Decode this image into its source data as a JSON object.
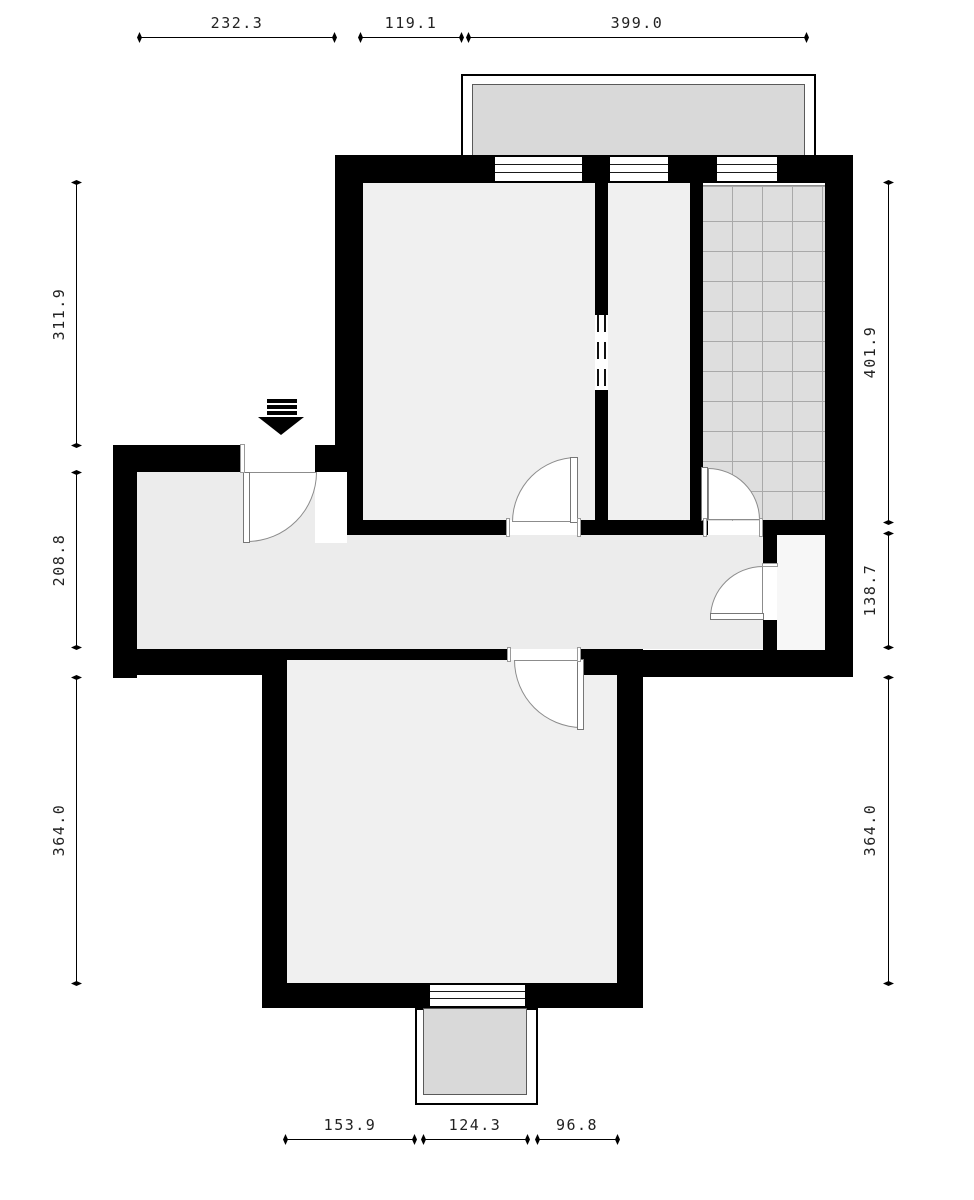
{
  "drawing": {
    "type": "apartment-floor-plan",
    "dimensions": {
      "top": [
        "232.3",
        "119.1",
        "399.0"
      ],
      "left": [
        "311.9",
        "208.8",
        "364.0"
      ],
      "right": [
        "401.9",
        "138.7",
        "364.0"
      ],
      "bottom": [
        "153.9",
        "124.3",
        "96.8"
      ]
    },
    "colors": {
      "wall": "#000000",
      "room_fill": "#f0f0f0",
      "hall_fill": "#ececec",
      "tile_fill": "#dedede",
      "tile_grid_line": "#a9a9a9",
      "balcony_fill": "#d9d9d9",
      "niche_fill": "#f7f7f7",
      "dimension_text": "#222222"
    },
    "icons": {
      "entrance_arrow": "entrance-direction-arrow"
    }
  }
}
